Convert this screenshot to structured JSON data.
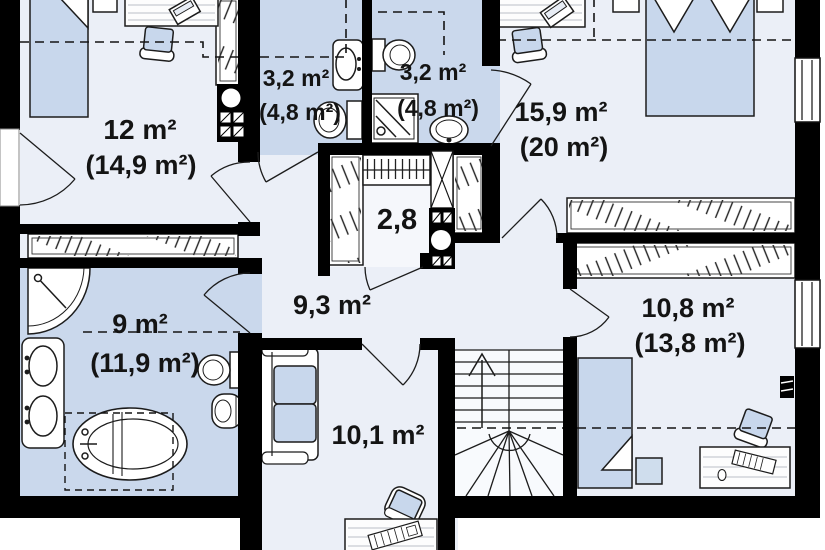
{
  "plan": {
    "type": "floor-plan",
    "colors": {
      "wall": "#000000",
      "room_floor": "#ebeff7",
      "wet_floor": "#cad8ec",
      "furniture_fill": "#c8d7ec",
      "line": "#1c1c1c",
      "background": "#ffffff"
    },
    "rooms": [
      {
        "name": "bedroom-top-left",
        "line1": "12 m²",
        "line2": "(14,9 m²)"
      },
      {
        "name": "bathroom-top-1",
        "line1": "3,2 m²",
        "line2": "(4,8 m²)"
      },
      {
        "name": "bathroom-top-2",
        "line1": "3,2 m²",
        "line2": "(4,8 m²)"
      },
      {
        "name": "bedroom-top-right",
        "line1": "15,9 m²",
        "line2": "(20 m²)"
      },
      {
        "name": "wardrobe-closet",
        "line1": "2,8"
      },
      {
        "name": "hall",
        "line1": "9,3 m²"
      },
      {
        "name": "bathroom-main",
        "line1": "9 m²",
        "line2": "(11,9 m²)"
      },
      {
        "name": "bedroom-bottom-right",
        "line1": "10,8 m²",
        "line2": "(13,8 m²)"
      },
      {
        "name": "room-bottom-middle",
        "line1": "10,1 m²"
      }
    ]
  }
}
